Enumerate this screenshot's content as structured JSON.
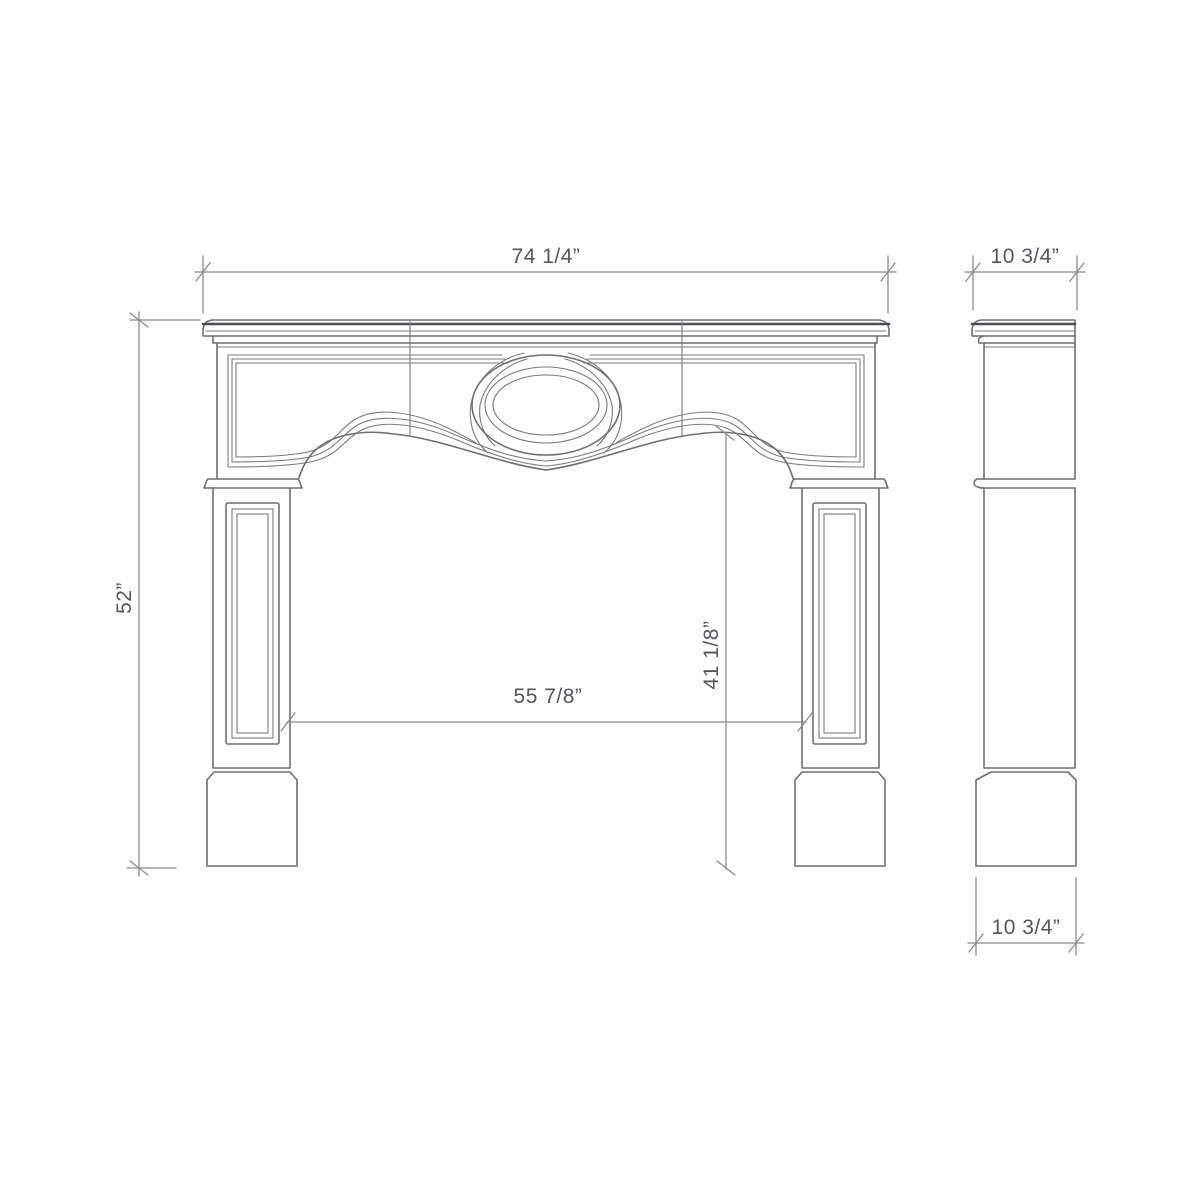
{
  "drawing": {
    "type": "technical dimension drawing - fireplace mantel, front and side elevations",
    "dimensions": {
      "front_overall_width": "74 1/4”",
      "side_depth_top": "10 3/4”",
      "overall_height": "52”",
      "opening_width": "55 7/8”",
      "opening_height": "41 1/8”",
      "side_depth_bottom": "10 3/4”"
    },
    "colors": {
      "outline": "#6e6f72",
      "heavy_line": "#4d4e52",
      "dimension_line": "#8a8b8e",
      "dimension_text": "#55565a",
      "background": "#ffffff"
    }
  }
}
